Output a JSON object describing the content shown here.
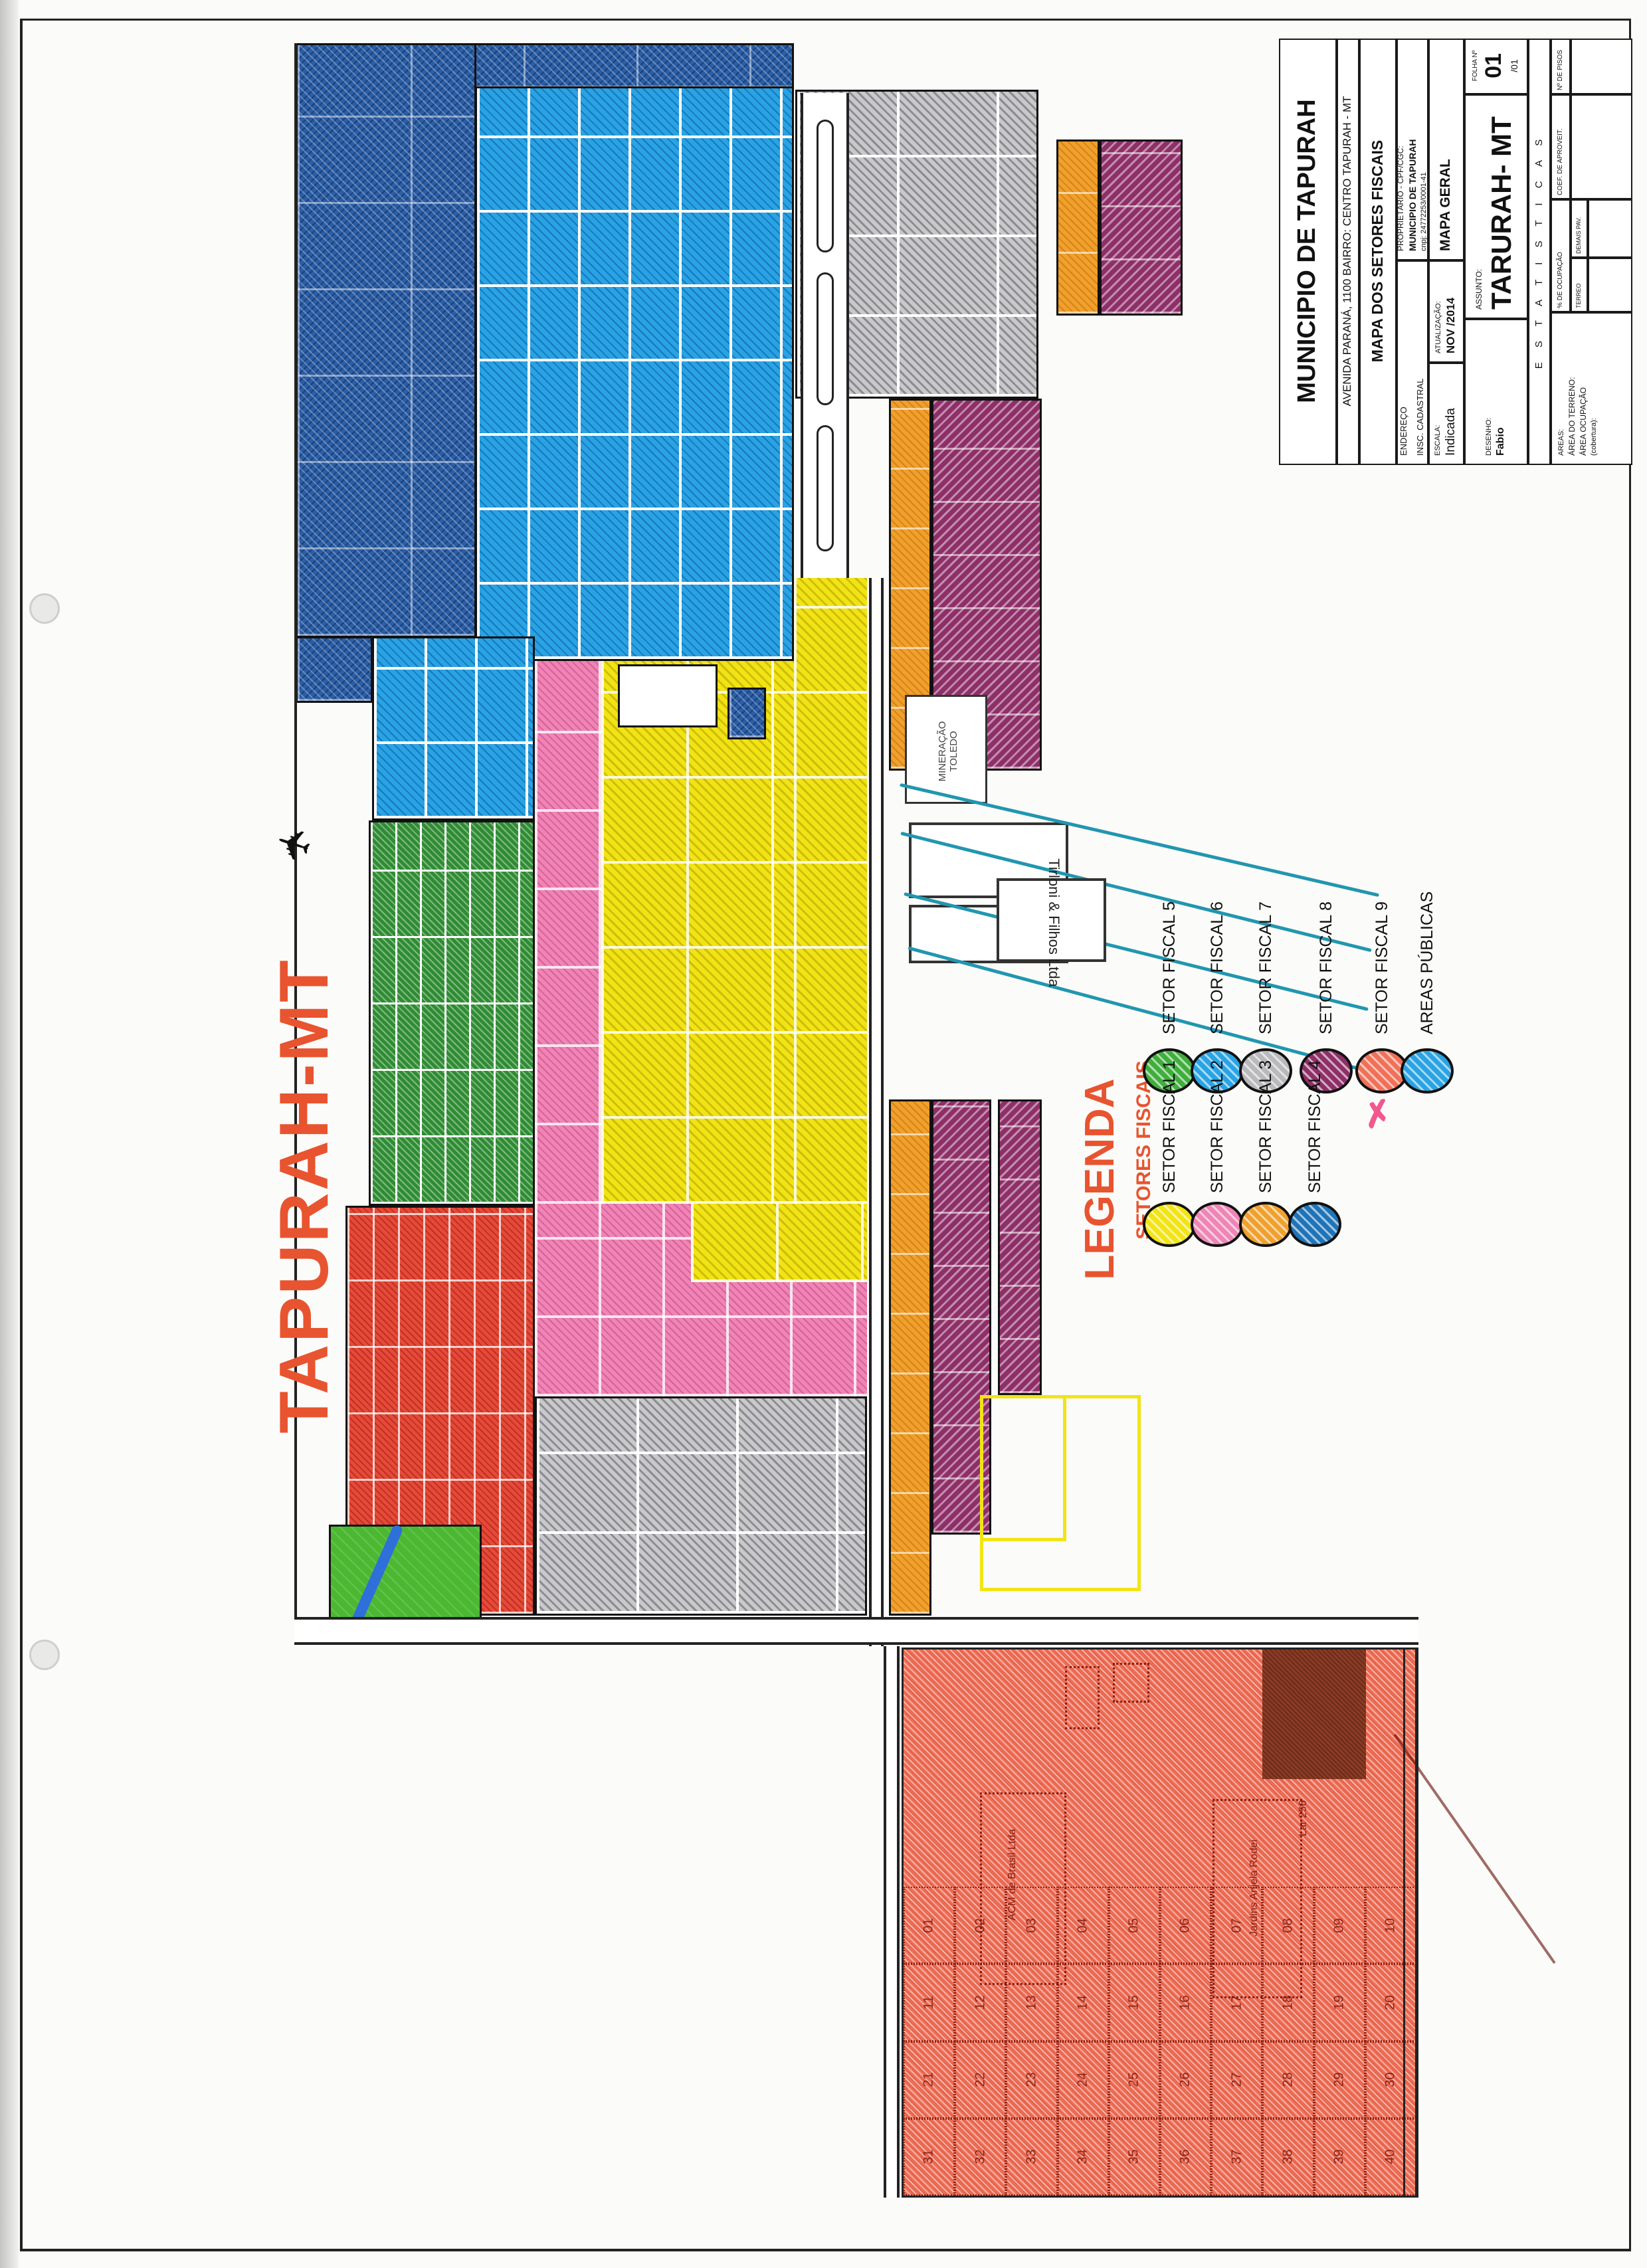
{
  "colors": {
    "accent": "#e8542f",
    "navy": "#2a5ea6",
    "cyan": "#29a3e3",
    "gray_sector": "#c9c9cc",
    "yellow": "#f2e414",
    "pink": "#ee85b5",
    "orange": "#f0a02c",
    "green": "#2f8c33",
    "purple": "#8e2f68",
    "salmon": "#ef6d55",
    "red": "#e64a38",
    "park": "#4cb832",
    "river": "#2e6fd9",
    "stream": "#2196b0",
    "brown": "#8c3b24",
    "ink": "#1a1a1a"
  },
  "title_block": {
    "municipality": "MUNICIPIO DE TAPURAH",
    "address": "AVENIDA PARANÁ, 1100      BAIRRO: CENTRO      TAPURAH - MT",
    "map_title": "MAPA DOS SETORES FISCAIS",
    "owner_label": "PROPRIETÁRIO - CPF/CGC:",
    "owner": "MUNICIPIO DE TAPURAH",
    "cnpj": "cnpj: 24772253/0001-41",
    "endereco_label": "ENDEREÇO",
    "insc_label": "INSC. CADASTRAL",
    "mapa_geral": "MAPA GERAL",
    "atualizacao_label": "ATUALIZAÇÃO:",
    "atualizacao_value": "NOV /2014",
    "escala_label": "ESCALA:",
    "escala_value": "Indicada",
    "desenho_label": "DESENHO:",
    "desenho_value": "Fabio",
    "assunto_label": "ASSUNTO:",
    "assunto_value": "TARURAH- MT",
    "folha_label": "FOLHA Nº",
    "folha_value": "01",
    "folha_sub": "/01",
    "statistics_header": "E S T A T I S T I C A S",
    "stat_floors": "Nº DE PISOS",
    "stat_coef": "COEF. DE APROVEIT.",
    "stat_occupancy": "% DE OCUPAÇÃO",
    "stat_ground": "TERREO",
    "stat_other_floors": "DEMAIS PAV.",
    "areas_label": "AREAS:",
    "areas_terrain": "ÁREA DO TERRENO:",
    "areas_occupation": "ÁREA OCUPAÇÃO",
    "areas_coverage": "(cobertura):"
  },
  "map": {
    "city_name": "TAPURAH-MT",
    "airplane_icon": "✈",
    "labels": {
      "tirloni": "Tirloni & Filhos Ltda",
      "mineracao_line1": "MINERAÇÃO",
      "mineracao_line2": "TOLEDO",
      "parcel_acm": "ACM de Brasil Ltda",
      "parcel_jardins": "Jardins Anjela Rodei",
      "parcel_lar": "Lar 256"
    }
  },
  "legend": {
    "title": "LEGENDA",
    "subtitle": "SETORES FISCAIS",
    "items": [
      {
        "label": "SETOR FISCAL 1",
        "color": "#f2e414"
      },
      {
        "label": "SETOR FISCAL 2",
        "color": "#ee85b5"
      },
      {
        "label": "SETOR FISCAL 3",
        "color": "#f0a02c"
      },
      {
        "label": "SETOR FISCAL 4",
        "color": "#1f74b8"
      },
      {
        "label": "SETOR FISCAL 5",
        "color": "#3fae3c"
      },
      {
        "label": "SETOR FISCAL 6",
        "color": "#29a3e3"
      },
      {
        "label": "SETOR FISCAL 7",
        "color": "#b9b9bb"
      },
      {
        "label": "SETOR FISCAL 8",
        "color": "#8e2f68"
      },
      {
        "label": "SETOR FISCAL 9",
        "color": "#f07058"
      },
      {
        "label": "AREAS PÚBLICAS",
        "color": "#29a3e3"
      }
    ]
  },
  "bottom_area": {
    "lot_numbers": [
      "01",
      "02",
      "03",
      "04",
      "05",
      "06",
      "07",
      "08",
      "09",
      "10",
      "11",
      "12",
      "13",
      "14",
      "15",
      "16",
      "17",
      "18",
      "19",
      "20",
      "21",
      "22",
      "23",
      "24",
      "25",
      "26",
      "27",
      "28",
      "29",
      "30",
      "31",
      "32",
      "33",
      "34",
      "35",
      "36",
      "37",
      "38",
      "39",
      "40"
    ]
  }
}
